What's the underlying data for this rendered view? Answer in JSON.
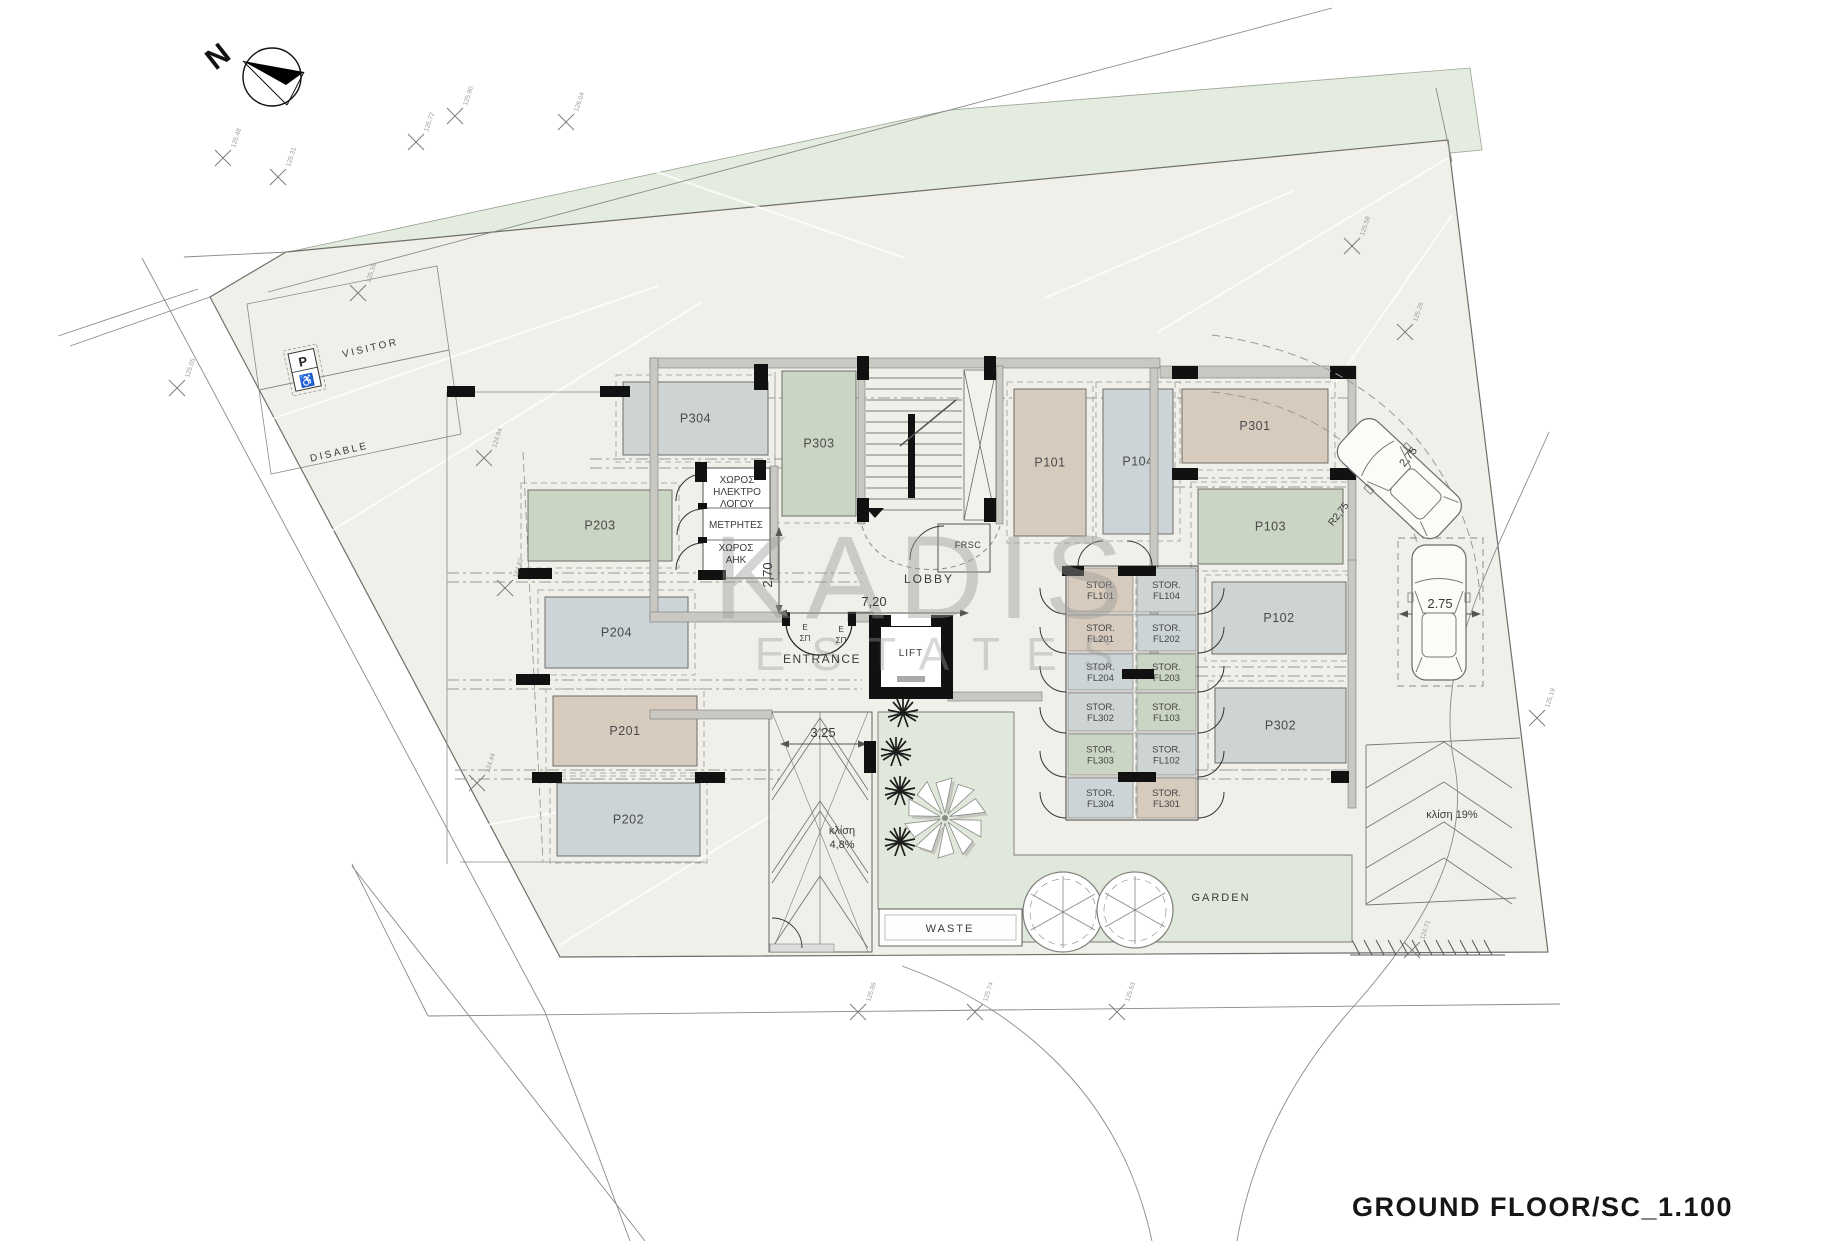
{
  "title": {
    "text": "GROUND FLOOR/SC_1.100"
  },
  "compass": {
    "letter": "N"
  },
  "watermark": {
    "line1": "KADIS",
    "line2": "ESTATES"
  },
  "colors": {
    "tan": "#d7cbbd",
    "green": "#cbd5c3",
    "grayblue": "#ccd4d8",
    "gray": "#ced3d3",
    "site": "#f0efe9",
    "field": "#e4ecdf",
    "garden": "#dfe8da",
    "wall": "#c9c8c2",
    "line": "#555555",
    "dash": "#999999"
  },
  "parking": [
    {
      "id": "P304",
      "x": 623,
      "y": 382,
      "w": 145,
      "h": 73,
      "c": "gray"
    },
    {
      "id": "P303",
      "x": 782,
      "y": 371,
      "w": 74,
      "h": 145,
      "c": "green"
    },
    {
      "id": "P101",
      "x": 1014,
      "y": 389,
      "w": 72,
      "h": 147,
      "c": "tan"
    },
    {
      "id": "P104",
      "x": 1103,
      "y": 389,
      "w": 70,
      "h": 145,
      "c": "grayblue"
    },
    {
      "id": "P301",
      "x": 1182,
      "y": 389,
      "w": 146,
      "h": 74,
      "c": "tan"
    },
    {
      "id": "P103",
      "x": 1198,
      "y": 489,
      "w": 145,
      "h": 75,
      "c": "green"
    },
    {
      "id": "P102",
      "x": 1212,
      "y": 582,
      "w": 134,
      "h": 72,
      "c": "gray"
    },
    {
      "id": "P302",
      "x": 1215,
      "y": 688,
      "w": 131,
      "h": 75,
      "c": "gray"
    },
    {
      "id": "P203",
      "x": 528,
      "y": 490,
      "w": 144,
      "h": 71,
      "c": "green"
    },
    {
      "id": "P204",
      "x": 545,
      "y": 597,
      "w": 143,
      "h": 71,
      "c": "grayblue"
    },
    {
      "id": "P201",
      "x": 553,
      "y": 696,
      "w": 144,
      "h": 70,
      "c": "tan"
    },
    {
      "id": "P202",
      "x": 557,
      "y": 783,
      "w": 143,
      "h": 73,
      "c": "grayblue"
    }
  ],
  "storage": {
    "prefix": "STOR.",
    "units": [
      {
        "code": "FL101",
        "x": 1068,
        "y": 568,
        "w": 65,
        "h": 44,
        "c": "tan"
      },
      {
        "code": "FL201",
        "x": 1068,
        "y": 615,
        "w": 65,
        "h": 36,
        "c": "tan"
      },
      {
        "code": "FL204",
        "x": 1068,
        "y": 654,
        "w": 65,
        "h": 36,
        "c": "grayblue"
      },
      {
        "code": "FL302",
        "x": 1068,
        "y": 693,
        "w": 65,
        "h": 38,
        "c": "gray"
      },
      {
        "code": "FL303",
        "x": 1068,
        "y": 734,
        "w": 65,
        "h": 41,
        "c": "green"
      },
      {
        "code": "FL304",
        "x": 1068,
        "y": 778,
        "w": 65,
        "h": 40,
        "c": "grayblue"
      },
      {
        "code": "FL104",
        "x": 1137,
        "y": 568,
        "w": 59,
        "h": 44,
        "c": "gray"
      },
      {
        "code": "FL202",
        "x": 1137,
        "y": 615,
        "w": 59,
        "h": 36,
        "c": "grayblue"
      },
      {
        "code": "FL203",
        "x": 1137,
        "y": 654,
        "w": 59,
        "h": 36,
        "c": "green"
      },
      {
        "code": "FL103",
        "x": 1137,
        "y": 693,
        "w": 59,
        "h": 38,
        "c": "green"
      },
      {
        "code": "FL102",
        "x": 1137,
        "y": 734,
        "w": 59,
        "h": 41,
        "c": "gray"
      },
      {
        "code": "FL301",
        "x": 1137,
        "y": 778,
        "w": 59,
        "h": 40,
        "c": "tan"
      }
    ]
  },
  "annotations": {
    "site_labels": [
      {
        "t": "VISITOR",
        "x": 371,
        "y": 351,
        "s": 10,
        "r": -13,
        "ls": 2.5
      },
      {
        "t": "DISABLE",
        "x": 340,
        "y": 455,
        "s": 10,
        "r": -13,
        "ls": 2.5
      },
      {
        "t": "LOBBY",
        "x": 929,
        "y": 583,
        "s": 12,
        "ls": 2
      },
      {
        "t": "ENTRANCE",
        "x": 822,
        "y": 663,
        "s": 12,
        "ls": 1.5
      },
      {
        "t": "LIFT",
        "x": 911,
        "y": 656,
        "s": 10,
        "ls": 1
      },
      {
        "t": "FRSC",
        "x": 968,
        "y": 548,
        "s": 9,
        "ls": 0.5
      },
      {
        "t": "WASTE",
        "x": 950,
        "y": 932,
        "s": 11,
        "ls": 2
      },
      {
        "t": "GARDEN",
        "x": 1221,
        "y": 901,
        "s": 11,
        "ls": 2
      },
      {
        "t": "κλίση",
        "x": 842,
        "y": 834,
        "s": 11
      },
      {
        "t": "4,8%",
        "x": 842,
        "y": 848,
        "s": 11
      },
      {
        "t": "κλίση 19%",
        "x": 1452,
        "y": 818,
        "s": 11
      },
      {
        "t": "E",
        "x": 805,
        "y": 630,
        "s": 8
      },
      {
        "t": "ΣΠ",
        "x": 805,
        "y": 641,
        "s": 8
      },
      {
        "t": "E",
        "x": 841,
        "y": 632,
        "s": 8
      },
      {
        "t": "ΣΠ",
        "x": 841,
        "y": 643,
        "s": 8
      }
    ],
    "room_labels": [
      {
        "t": "ΧΩΡΟΣ",
        "x": 737,
        "y": 483,
        "s": 10
      },
      {
        "t": "ΗΛΕΚΤΡΟ",
        "x": 737,
        "y": 495,
        "s": 10
      },
      {
        "t": "ΛΟΓΟΥ",
        "x": 737,
        "y": 507,
        "s": 10
      },
      {
        "t": "ΜΕΤΡΗΤΕΣ",
        "x": 736,
        "y": 528,
        "s": 10
      },
      {
        "t": "ΧΩΡΟΣ",
        "x": 736,
        "y": 551,
        "s": 10
      },
      {
        "t": "ΑΗΚ",
        "x": 736,
        "y": 563,
        "s": 10
      }
    ],
    "dim_labels": [
      {
        "t": "7,20",
        "x": 874,
        "y": 606,
        "s": 13
      },
      {
        "t": "2,70",
        "x": 772,
        "y": 575,
        "s": 13,
        "r": -90
      },
      {
        "t": "3,25",
        "x": 823,
        "y": 737,
        "s": 13
      },
      {
        "t": "2.75",
        "x": 1440,
        "y": 608,
        "s": 13
      },
      {
        "t": "2,75",
        "x": 1411,
        "y": 459,
        "s": 11,
        "r": -52
      },
      {
        "t": "R2,75",
        "x": 1341,
        "y": 516,
        "s": 10,
        "r": -52
      }
    ]
  },
  "crosses": [
    {
      "x": 223,
      "y": 158,
      "l": "125.48"
    },
    {
      "x": 278,
      "y": 177,
      "l": "125.31"
    },
    {
      "x": 416,
      "y": 142,
      "l": "125.72"
    },
    {
      "x": 455,
      "y": 116,
      "l": "125.90"
    },
    {
      "x": 566,
      "y": 122,
      "l": "126.04"
    },
    {
      "x": 358,
      "y": 293,
      "l": "125.16"
    },
    {
      "x": 177,
      "y": 388,
      "l": "125.05"
    },
    {
      "x": 484,
      "y": 458,
      "l": "124.94"
    },
    {
      "x": 505,
      "y": 588,
      "l": "124.82"
    },
    {
      "x": 477,
      "y": 783,
      "l": "124.44"
    },
    {
      "x": 1352,
      "y": 246,
      "l": "125.58"
    },
    {
      "x": 1405,
      "y": 332,
      "l": "125.26"
    },
    {
      "x": 1537,
      "y": 718,
      "l": "125.19"
    },
    {
      "x": 858,
      "y": 1012,
      "l": "125.86"
    },
    {
      "x": 975,
      "y": 1012,
      "l": "125.74"
    },
    {
      "x": 1117,
      "y": 1012,
      "l": "125.63"
    },
    {
      "x": 1412,
      "y": 950,
      "l": "124.71"
    }
  ]
}
